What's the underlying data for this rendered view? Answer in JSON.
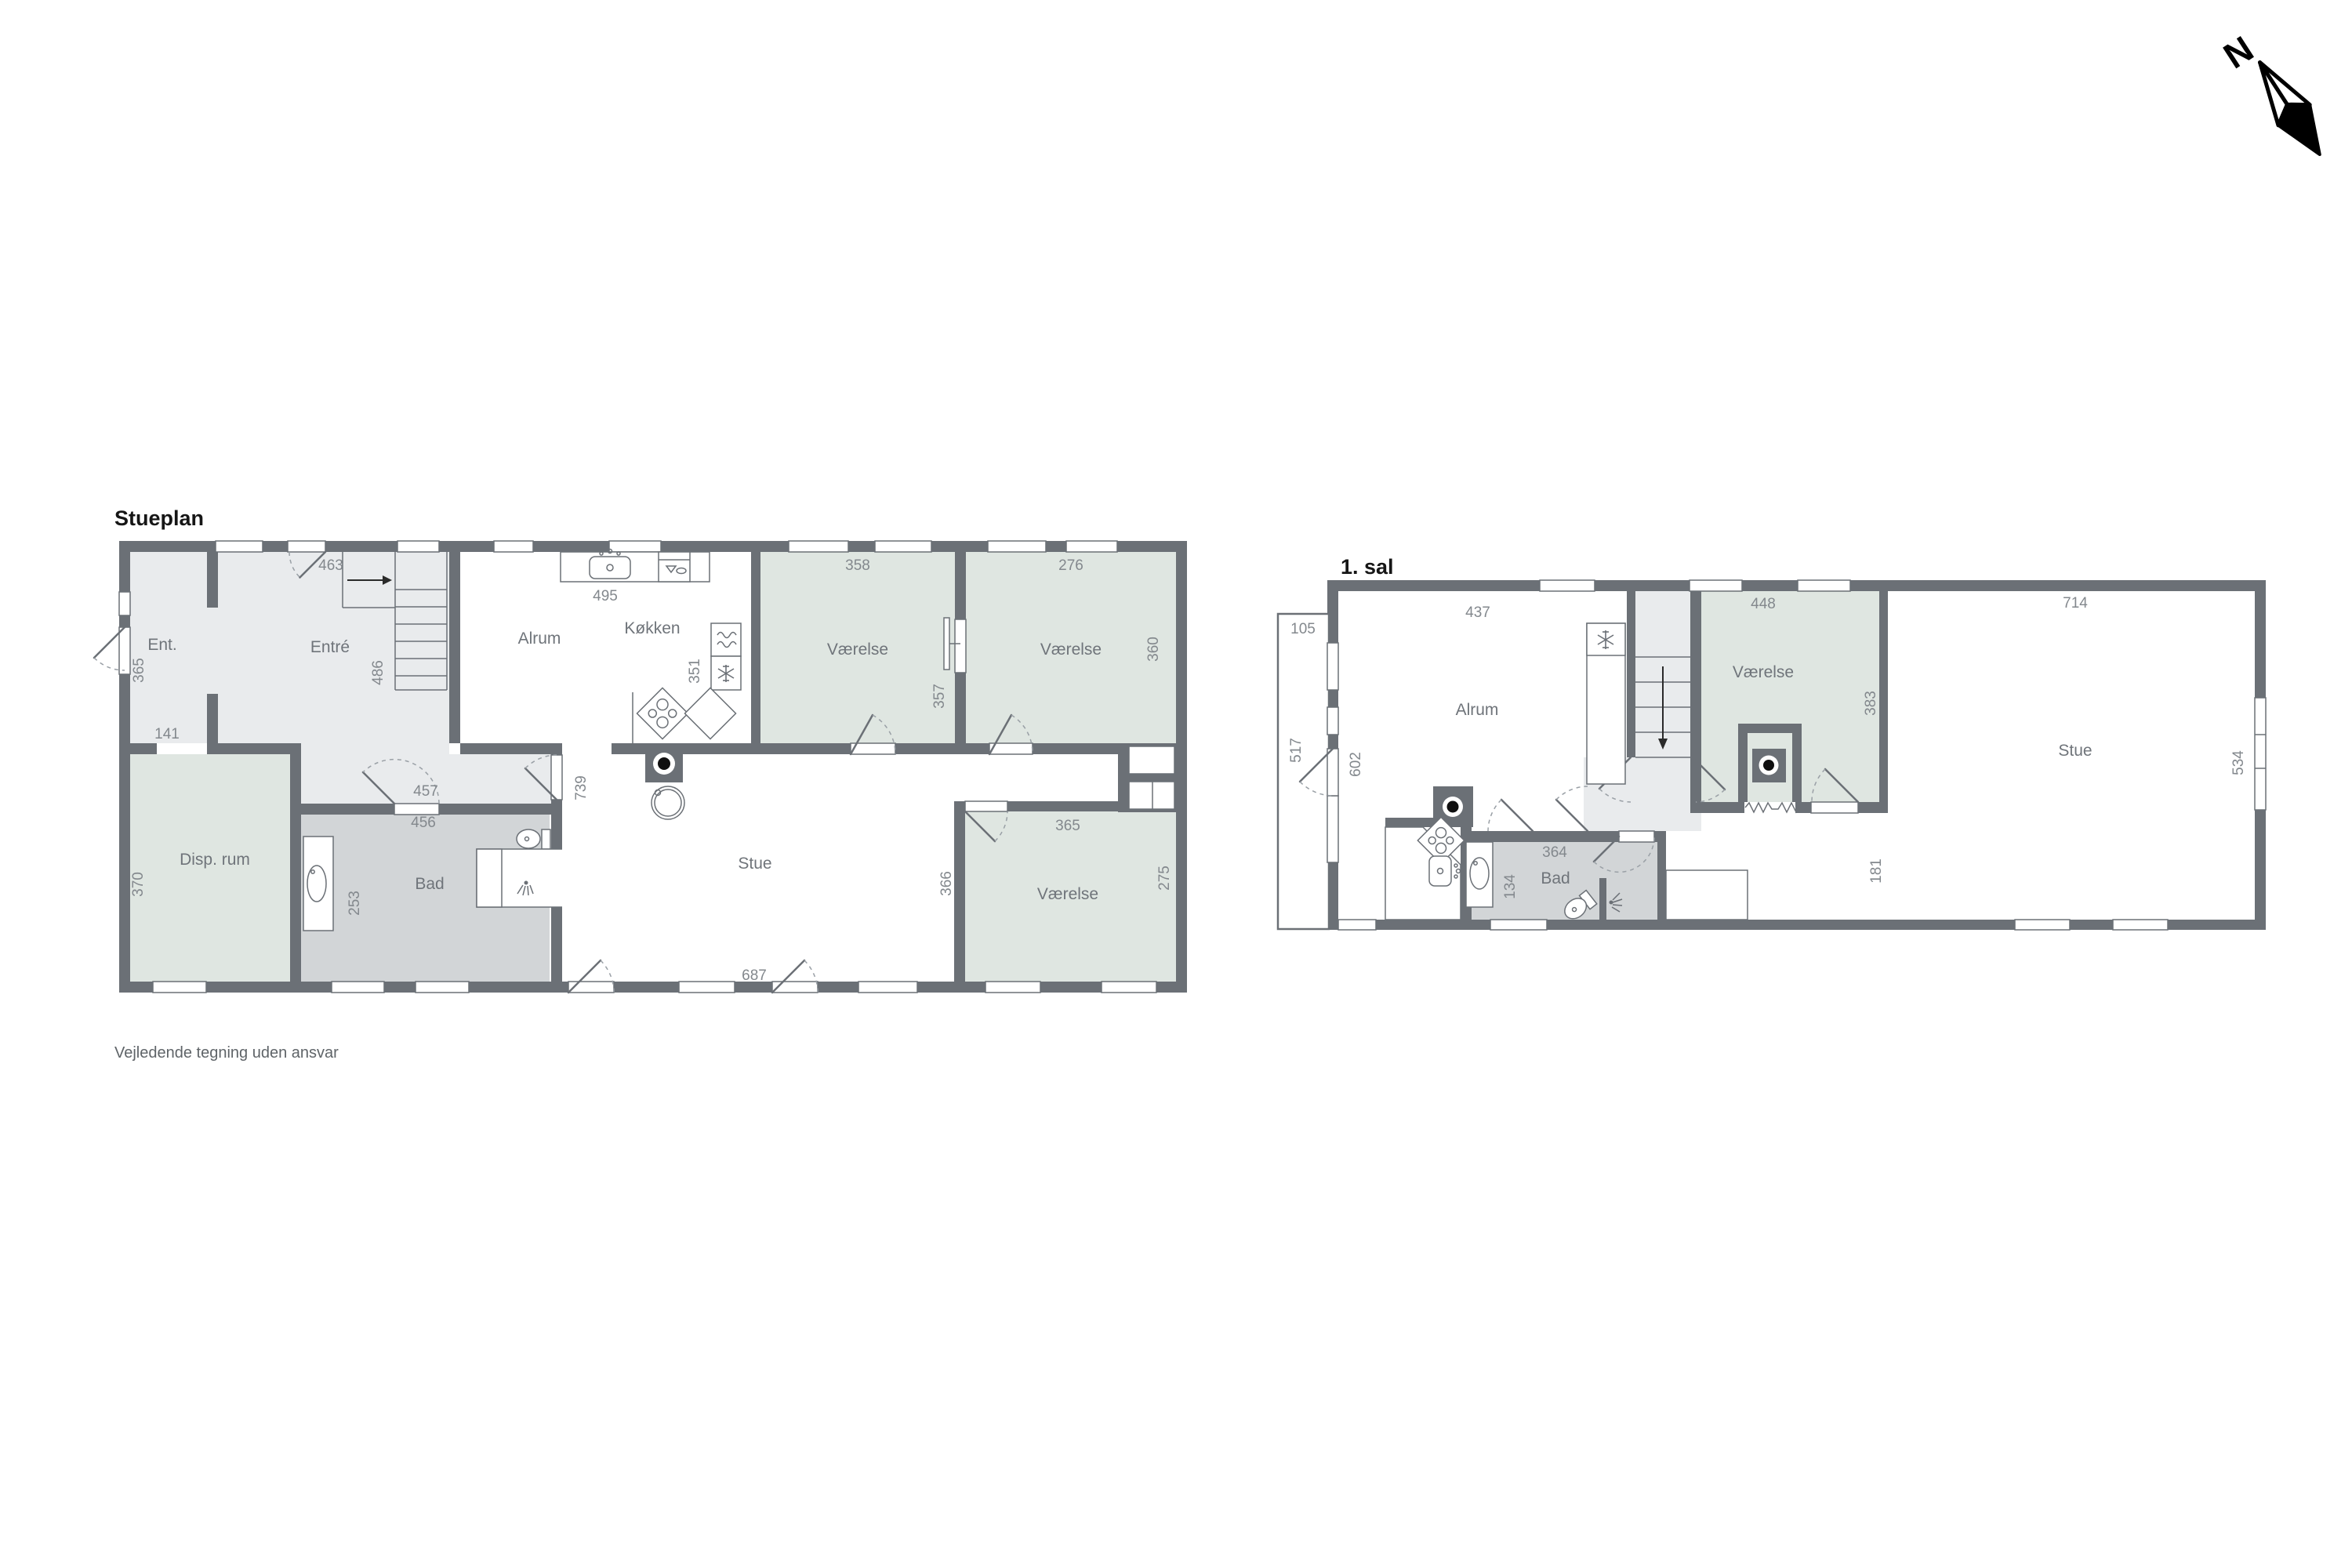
{
  "compass": {
    "label": "N"
  },
  "footer": {
    "text": "Vejledende tegning uden ansvar"
  },
  "stueplan": {
    "title": "Stueplan",
    "labels": {
      "ent": "Ent.",
      "entre": "Entré",
      "alrum": "Alrum",
      "kokken": "Køkken",
      "vaerelse_top1": "Værelse",
      "vaerelse_top2": "Værelse",
      "vaerelse_br": "Værelse",
      "disp_rum": "Disp. rum",
      "bad": "Bad",
      "stue": "Stue"
    },
    "dims": {
      "d463": "463",
      "d365_ent": "365",
      "d141": "141",
      "d486": "486",
      "d495": "495",
      "d351": "351",
      "d739": "739",
      "d457": "457",
      "d456": "456",
      "d253": "253",
      "d370": "370",
      "d358": "358",
      "d357": "357",
      "d276": "276",
      "d360": "360",
      "d687": "687",
      "d365_br": "365",
      "d366": "366",
      "d275": "275"
    }
  },
  "firstfloor": {
    "title": "1. sal",
    "labels": {
      "alrum": "Alrum",
      "vaerelse": "Værelse",
      "stue": "Stue",
      "bad": "Bad"
    },
    "dims": {
      "d437": "437",
      "d105": "105",
      "d517": "517",
      "d602": "602",
      "d448": "448",
      "d383": "383",
      "d364": "364",
      "d134": "134",
      "d181": "181",
      "d714": "714",
      "d534": "534"
    }
  }
}
